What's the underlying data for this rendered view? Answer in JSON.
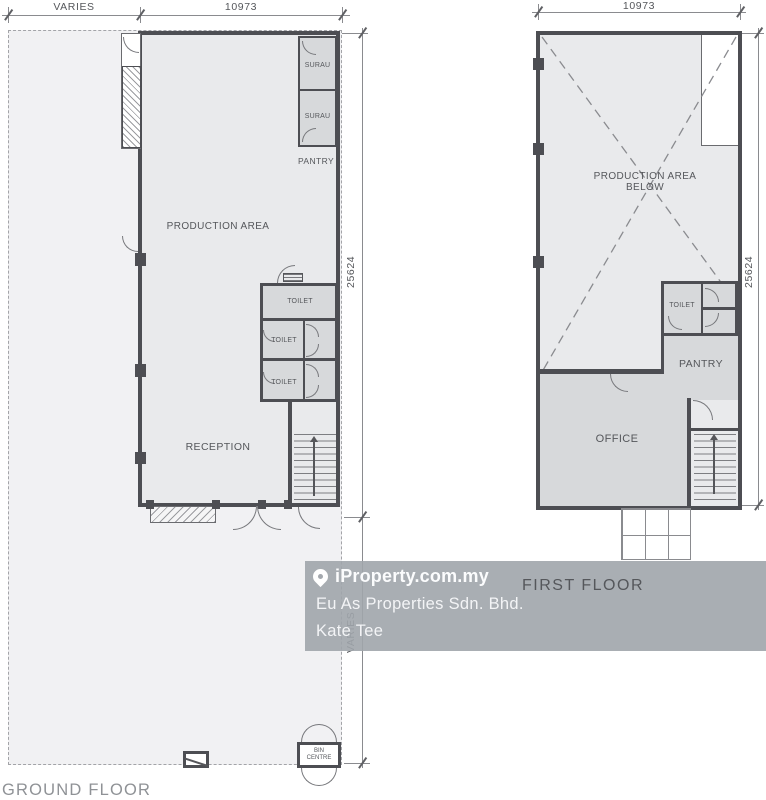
{
  "colors": {
    "wall": "#4d4e53",
    "lot_fill": "#f1f1f3",
    "floor_fill": "#e9eaec",
    "room_fill": "#d7d9db",
    "dimension_text": "#55575b",
    "watermark_band": "#a0a5ab",
    "watermark_text": "#fbfcfd",
    "title_text": "#8f9296"
  },
  "ground_floor": {
    "title": "GROUND FLOOR",
    "dimensions": {
      "top_left": "VARIES",
      "top_right": "10973",
      "right_upper": "25624",
      "right_lower": "VARIES"
    },
    "rooms": {
      "surau_1": "SURAU",
      "surau_2": "SURAU",
      "pantry": "PANTRY",
      "production_area": "PRODUCTION AREA",
      "toilet_1": "TOILET",
      "toilet_2": "TOILET",
      "toilet_3": "TOILET",
      "reception": "RECEPTION",
      "bin_centre_line_1": "BIN",
      "bin_centre_line_2": "CENTRE"
    }
  },
  "first_floor": {
    "title": "FIRST FLOOR",
    "dimensions": {
      "top": "10973",
      "right": "25624"
    },
    "rooms": {
      "production_below_line_1": "PRODUCTION AREA",
      "production_below_line_2": "BELOW",
      "toilet": "TOILET",
      "pantry": "PANTRY",
      "office": "OFFICE"
    }
  },
  "watermark": {
    "brand": "iProperty.com.my",
    "agency": "Eu As Properties Sdn. Bhd.",
    "agent": "Kate Tee",
    "icon": "location-pin-icon"
  }
}
